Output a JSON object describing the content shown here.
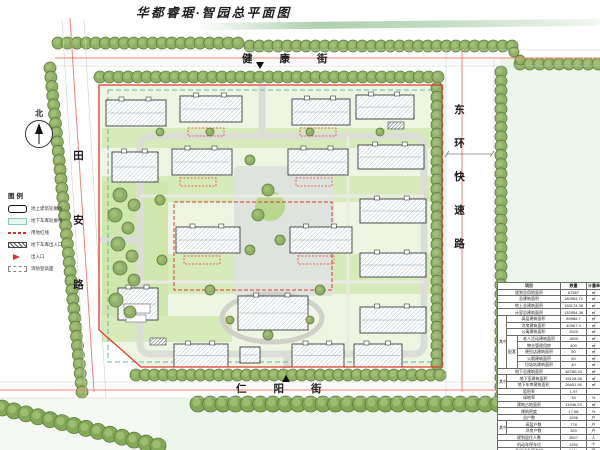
{
  "title": "华都睿琚·智园总平面图",
  "north": {
    "label": "北"
  },
  "streets": {
    "top": "健康街",
    "bottom": "仁阳街",
    "left": "田安路",
    "right": "东环快速路"
  },
  "legend": {
    "title": "图例",
    "items": [
      {
        "name": "building-outline",
        "label": "地上建筑轮廓线"
      },
      {
        "name": "garage-outline",
        "label": "地下车库轮廓线"
      },
      {
        "name": "red-line",
        "label": "用地红线"
      },
      {
        "name": "garage-entrance",
        "label": "地下车库出入口"
      },
      {
        "name": "entrance",
        "label": "出入口"
      },
      {
        "name": "fire-lane",
        "label": "消防登高面"
      }
    ]
  },
  "metrics_table": {
    "rows": [
      {
        "cells": [
          {
            "t": "项目",
            "cs": 3,
            "h": 1
          },
          {
            "t": "数量",
            "h": 1
          },
          {
            "t": "计量单位",
            "h": 1
          }
        ]
      },
      {
        "cells": [
          {
            "t": "规划总用地面积",
            "cs": 3
          },
          {
            "t": "67567"
          },
          {
            "t": "㎡"
          }
        ]
      },
      {
        "cells": [
          {
            "t": "总建筑面积",
            "cs": 3
          },
          {
            "t": "180954.71"
          },
          {
            "t": "㎡"
          }
        ]
      },
      {
        "cells": [
          {
            "t": "地上总建筑面积",
            "cs": 3
          },
          {
            "t": "135174.38"
          },
          {
            "t": "㎡"
          }
        ]
      },
      {
        "cells": [
          {
            "t": "计容总建筑面积",
            "cs": 3
          },
          {
            "t": "132954.38"
          },
          {
            "t": "㎡"
          }
        ]
      },
      {
        "cells": [
          {
            "t": "其中",
            "rs": 8
          },
          {
            "t": "高层建筑面积",
            "cs": 2
          },
          {
            "t": "89986.7"
          },
          {
            "t": "㎡"
          }
        ]
      },
      {
        "cells": [
          {
            "t": "洋房建筑面积",
            "cs": 2
          },
          {
            "t": "40967.3"
          },
          {
            "t": "㎡"
          }
        ]
      },
      {
        "cells": [
          {
            "t": "公寓建筑面积",
            "cs": 2
          },
          {
            "t": "2520"
          },
          {
            "t": "㎡"
          }
        ]
      },
      {
        "cells": [
          {
            "t": "配套",
            "rs": 5
          },
          {
            "t": "老人活动建筑面积"
          },
          {
            "t": "1800"
          },
          {
            "t": "㎡"
          }
        ]
      },
      {
        "cells": [
          {
            "t": "物业管理用房"
          },
          {
            "t": "400"
          },
          {
            "t": "㎡"
          }
        ]
      },
      {
        "cells": [
          {
            "t": "便民店建筑面积"
          },
          {
            "t": "50"
          },
          {
            "t": "㎡"
          }
        ]
      },
      {
        "cells": [
          {
            "t": "公厕建筑面积"
          },
          {
            "t": "50"
          },
          {
            "t": "㎡"
          }
        ]
      },
      {
        "cells": [
          {
            "t": "垃圾站建筑面积"
          },
          {
            "t": "40"
          },
          {
            "t": "㎡"
          }
        ]
      },
      {
        "cells": [
          {
            "t": "地下总建筑面积",
            "cs": 3
          },
          {
            "t": "45780.33"
          },
          {
            "t": "㎡"
          }
        ]
      },
      {
        "cells": [
          {
            "t": "其中",
            "rs": 2
          },
          {
            "t": "地下室建筑面积",
            "cs": 2
          },
          {
            "t": "19128.38"
          },
          {
            "t": "㎡"
          }
        ]
      },
      {
        "cells": [
          {
            "t": "地下车库建筑面积",
            "cs": 2
          },
          {
            "t": "26651.95"
          },
          {
            "t": "㎡"
          }
        ]
      },
      {
        "cells": [
          {
            "t": "容积率",
            "cs": 3
          },
          {
            "t": "1.97"
          },
          {
            "t": ""
          }
        ]
      },
      {
        "cells": [
          {
            "t": "绿地率",
            "cs": 3
          },
          {
            "t": "35"
          },
          {
            "t": "%"
          }
        ]
      },
      {
        "cells": [
          {
            "t": "建筑占地面积",
            "cs": 3
          },
          {
            "t": "11946.23"
          },
          {
            "t": "㎡"
          }
        ]
      },
      {
        "cells": [
          {
            "t": "建筑密度",
            "cs": 3
          },
          {
            "t": "17.68"
          },
          {
            "t": "%"
          }
        ]
      },
      {
        "cells": [
          {
            "t": "总户数",
            "cs": 3
          },
          {
            "t": "1096"
          },
          {
            "t": "户"
          }
        ]
      },
      {
        "cells": [
          {
            "t": "其中",
            "rs": 2
          },
          {
            "t": "高层户数",
            "cs": 2
          },
          {
            "t": "776"
          },
          {
            "t": "户"
          }
        ]
      },
      {
        "cells": [
          {
            "t": "洋房户数",
            "cs": 2
          },
          {
            "t": "320"
          },
          {
            "t": "户"
          }
        ]
      },
      {
        "cells": [
          {
            "t": "规划居住人数",
            "cs": 3
          },
          {
            "t": "3507"
          },
          {
            "t": "人"
          }
        ]
      },
      {
        "cells": [
          {
            "t": "机动车停车位",
            "cs": 3
          },
          {
            "t": "1352"
          },
          {
            "t": "个"
          }
        ]
      },
      {
        "cells": [
          {
            "t": "非机动车停车位",
            "cs": 3
          },
          {
            "t": "2366"
          },
          {
            "t": "辆"
          }
        ]
      }
    ]
  },
  "colors": {
    "red_line": "#e23a2a",
    "centerline": "#f08273",
    "tree": "#8fb065",
    "tree_dark": "#5f7d3e",
    "tree_inner": "#a9c47e",
    "tree_big": "#83a957",
    "lawn": "#d7eab9",
    "site_bg": "#eef5e2",
    "block_bg": "#edf6ea",
    "hatch": "#b6c6cf",
    "plaza": "#dfe3dd",
    "garage_line": "#63b8a6",
    "ring_road": "#dcddd6"
  }
}
